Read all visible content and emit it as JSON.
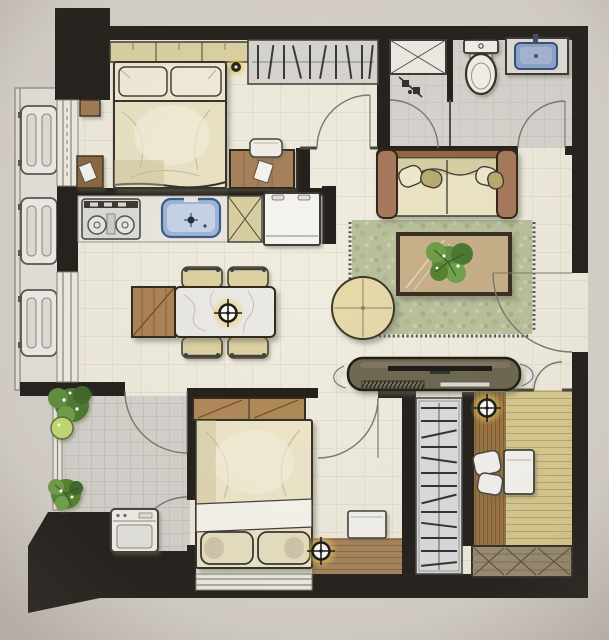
{
  "scene": {
    "description": "hand-drawn watercolor floor plan of a two-bedroom apartment, top-down view, no text labels"
  },
  "colors": {
    "paper": "#d7d2cb",
    "wall": "#24211d",
    "floor": "#f0ecdf",
    "floorGrid": "#d8d3c4",
    "bathFloor": "#d8d5d0",
    "bathGrid": "#c3c0ba",
    "laundryFloor": "#d6d3ce",
    "laundryGrid": "#b9b6af",
    "wood": "#a8815a",
    "woodDark": "#6b4a28",
    "woodEdge": "#33291e",
    "wardrobe": "#ddd3a4",
    "closetGray": "#d9d7d3",
    "bedding": "#eee7ca",
    "beddingShade": "#cfc5a0",
    "pillow": "#f3eeda",
    "sofaWood": "#a87a5c",
    "cushion": "#ece6c6",
    "oliveWash": "#c9bf8e",
    "rug": "#b9c19c",
    "rugDot": "#9aa37e",
    "plant": "#5f8f3f",
    "plantDark": "#3f6b2a",
    "plantLight": "#c6da74",
    "sinkBlue": "#9fb6d6",
    "sinkBlueDark": "#3c5c8c",
    "basinBlue": "#8fa5c8",
    "applianceWhite": "#f4f3ee",
    "stoveGray": "#dcdcda",
    "consoleOlive": "#6e6753",
    "studyFloor": "#d8ca90",
    "studyPlank": "#b9a96e",
    "deskWood": "#9a7342",
    "deskGrain": "#7e5c34",
    "bed2Wood": "#a8855c",
    "cabinetKhaki": "#9b8d72",
    "glow": "#f0cf5e",
    "lineSoft": "#7d786d",
    "outline": "#3a362e"
  },
  "rooms": [
    {
      "name": "bedroom-1",
      "furniture": [
        "wardrobe",
        "hanging-closet-rack",
        "double-bed",
        "pillows",
        "bedside-stools",
        "desk",
        "chair",
        "wall-light"
      ]
    },
    {
      "name": "bathroom",
      "furniture": [
        "pipe-shaft",
        "shower-stall",
        "toilet",
        "vanity-sink",
        "doors"
      ]
    },
    {
      "name": "kitchen",
      "furniture": [
        "two-burner-cooktop",
        "kitchen-sink",
        "tall-cabinet",
        "refrigerator"
      ]
    },
    {
      "name": "dining-area",
      "furniture": [
        "wood-and-marble-table",
        "chair",
        "chair",
        "chair",
        "chair",
        "ceiling-light"
      ]
    },
    {
      "name": "living-room",
      "furniture": [
        "wood-frame-sofa",
        "area-rug",
        "coffee-table-with-plant",
        "round-ottoman",
        "tv-console",
        "entry-door"
      ]
    },
    {
      "name": "service-balcony",
      "furniture": [
        "washing-machine",
        "potted-plants",
        "doors"
      ]
    },
    {
      "name": "bedroom-2",
      "furniture": [
        "overbed-wardrobe",
        "double-bed",
        "nightstand",
        "ceiling-light",
        "window"
      ]
    },
    {
      "name": "study",
      "furniture": [
        "desk-counter",
        "chair",
        "side-table",
        "hanger-wardrobe",
        "storage-cabinet",
        "ceiling-light"
      ]
    },
    {
      "name": "left-balcony",
      "furniture": [
        "ac-condenser",
        "ac-condenser",
        "ac-condenser"
      ]
    }
  ],
  "lights": {
    "ceiling_lights": 3,
    "wall_lights": 1
  }
}
